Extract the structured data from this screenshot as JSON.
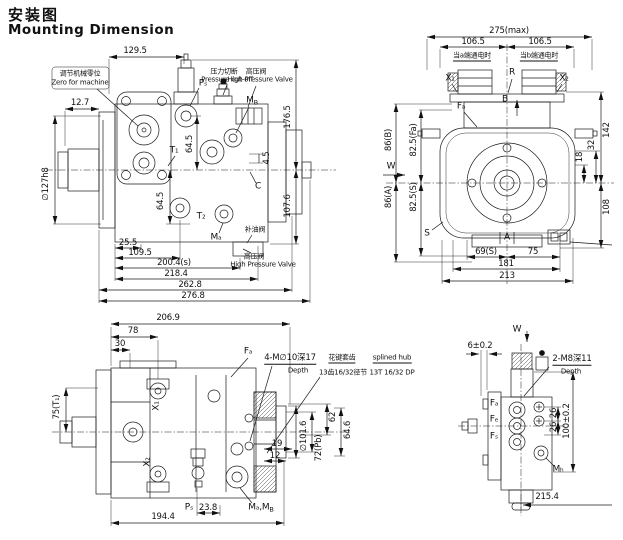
{
  "title": {
    "zh": "安装图",
    "en": "Mounting Dimension"
  },
  "side_view": {
    "dims": {
      "w129_5": "129.5",
      "w12_7": "12.7",
      "shaft_dia": "∅127h8",
      "h176_5": "176.5",
      "h107_6": "107.6",
      "h64_5_top": "64.5",
      "h64_5_bottom": "64.5",
      "h4_5": "4.5",
      "l25_5": "25.5",
      "l109_5": "109.5",
      "l200_4": "200.4(s)",
      "l218_4": "218.4",
      "l262_8": "262.8",
      "l276_8": "276.8"
    },
    "ports": {
      "ps": "Pₛ",
      "t1": "T₁",
      "t2": "T₂",
      "ma": "Mₐ",
      "mb": {
        "m": "M",
        "s": "B"
      },
      "c": "C"
    },
    "notes": {
      "zero_zh": "调节机械零位",
      "zero_en": "Zero for machine",
      "cutoff_zh": "压力切断",
      "cutoff_en": "Pressure cut-off",
      "hpv_zh": "高压阀",
      "hpv_en": "High Pressure Valve",
      "charge_zh": "补油阀",
      "hpv2_zh": "高压阀",
      "hpv2_en": "High Pressure Valve"
    }
  },
  "rear_view": {
    "dims": {
      "w275": "275(max)",
      "w106_5_a": "106.5",
      "w106_5_b": "106.5",
      "h142": "142",
      "h108": "108",
      "h18": "18",
      "h32": "32",
      "h86b": "86(B)",
      "h82_5fa": "82.5(Fa)",
      "h86a": "86(A)",
      "h82_5s": "82.5(S)",
      "w69s": "69(S)",
      "w75": "75",
      "w181": "181",
      "w213": "213"
    },
    "notes": {
      "sol_a": "当a端通电时",
      "sol_b": "当b端通电时"
    },
    "ports": {
      "x1": "X₁",
      "x2": "X₂",
      "r": "R",
      "b": "B",
      "fa": "Fₐ",
      "s": "S",
      "a": "A",
      "w_arrow": "W"
    }
  },
  "top_view": {
    "dims": {
      "w206_9": "206.9",
      "w78": "78",
      "w30": "30",
      "h75t1": "75(T₁)",
      "d101_6": "∅101.6",
      "h72pb": "72(Pb)",
      "h62": "62",
      "h64_6": "64.6",
      "w19": "19",
      "w12": "12",
      "w23_8": "23.8",
      "w194_4": "194.4"
    },
    "ports": {
      "x1": "X₁",
      "x2": "X₂",
      "fa": "Fₐ",
      "ps": "Pₛ",
      "mamb": {
        "m": "Mₐ,M",
        "s": "B"
      }
    },
    "notes": {
      "holes": "4-M∅10深17",
      "holes_sub": "Depth",
      "spline_zh_1": "花键套齿",
      "spline_zh_2": "13齿16/32径节",
      "spline_en_1": "splined hub",
      "spline_en_2": "13T 16/32 DP"
    }
  },
  "end_view": {
    "view_label": "W",
    "dims": {
      "w6": "6±0.2",
      "h26_a": "26",
      "h26_b": "26",
      "h100": "100±0.2",
      "w215_4": "215.4"
    },
    "ports": {
      "fa": "Fₐ",
      "fe": "Fₑ",
      "fs": "Fₛ",
      "mh": "Mₕ"
    },
    "notes": {
      "holes": "2-M8深11",
      "holes_sub": "Depth"
    }
  }
}
